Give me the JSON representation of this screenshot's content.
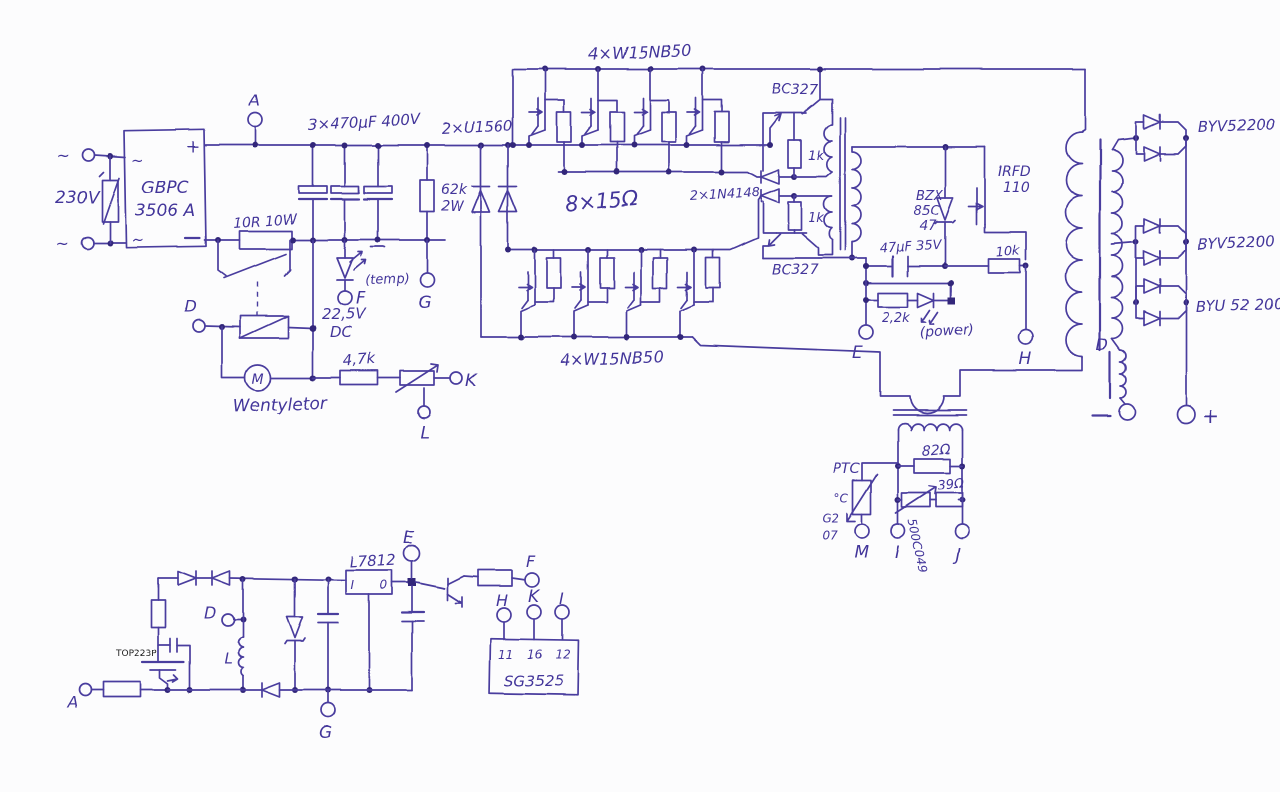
{
  "colors": {
    "ink": "#4a3c9e",
    "dot": "#33287a",
    "paper": "#fcfcfd"
  },
  "input": {
    "tilde1": "~",
    "tilde2": "~",
    "voltage": "230V"
  },
  "bridge": {
    "name1": "GBPC",
    "name2": "3506 A",
    "plus": "+",
    "ac1": "~",
    "ac2": "~"
  },
  "bus": {
    "caps": "3×470µF 400V",
    "inrush": "10R 10W",
    "bleeder_v": "62k",
    "bleeder_w": "2W",
    "clamp_d": "2×U1560",
    "temp": "(temp)",
    "relay_v": "22,5V",
    "relay_dc": "DC"
  },
  "fan": {
    "motor": "M",
    "name": "Wentyletor",
    "r": "4,7k"
  },
  "inv": {
    "bank_top": "4×W15NB50",
    "bank_bot": "4×W15NB50",
    "gate_r": "8×15Ω",
    "dd": "2×1N4148",
    "q_top": "BC327",
    "q_bot": "BC327",
    "r_top": "1k",
    "r_bot": "1k"
  },
  "clamp": {
    "z1": "BZX",
    "z2": "85C",
    "z3": "47",
    "q1": "IRFD",
    "q2": "110",
    "c": "47µF 35V",
    "r1": "10k",
    "r2": "2,2k",
    "led": "(power)"
  },
  "ct": {
    "ptc": "PTC",
    "deg": "°C",
    "g2": "G2",
    "n07": "07",
    "r82": "82Ω",
    "r39": "39Ω",
    "trim": "500C049"
  },
  "out": {
    "d1": "BYV52200",
    "d2": "BYV52200",
    "d3": "BYU 52 200",
    "choke": "D",
    "plus": "+"
  },
  "aux": {
    "chip": "TOP223P",
    "reg": "L7812",
    "reg_i": "I",
    "reg_o": "0",
    "ind": "L",
    "pwm": "SG3525",
    "p11": "11",
    "p16": "16",
    "p12": "12"
  },
  "terminals": {
    "a": "A",
    "d": "D",
    "e": "E",
    "f": "F",
    "g": "G",
    "h": "H",
    "i": "I",
    "j": "J",
    "k": "K",
    "l": "L",
    "m": "M"
  }
}
